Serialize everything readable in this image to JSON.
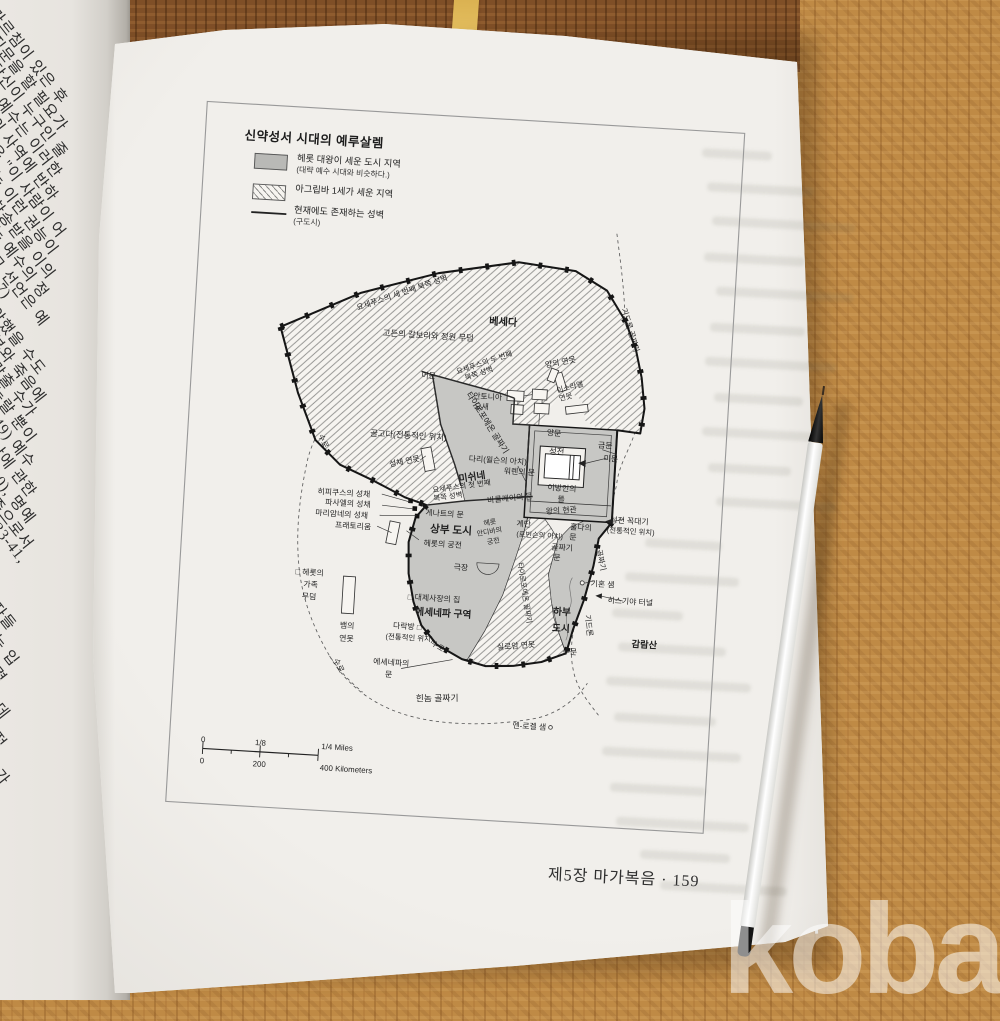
{
  "watermark": {
    "text": "kobay"
  },
  "book": {
    "footer": "제5장 마가복음 · 159"
  },
  "left_page": {
    "lines": [
      {
        "t": "가르침이 있은 후",
        "y": 3
      },
      {
        "t": "질문을 할 필요가",
        "y": 30
      },
      {
        "t": "당신이 누구인 줄",
        "y": 57
      },
      {
        "t": ") 예수는 이러한",
        "y": 84
      },
      {
        "t": "의 사역에 반하",
        "y": 112
      },
      {
        "t": "은 \"이 사람이 어",
        "y": 139
      },
      {
        "t": "는 이런 권능이",
        "y": 166
      },
      {
        "t": "찬송받을 이의",
        "y": 194
      },
      {
        "t": "는 예수의 정",
        "y": 221
      },
      {
        "t": "그 선언은 예",
        "y": 249
      },
      {
        "t": ":7)",
        "y": 276
      },
      {
        "t": "악했을 수도",
        "y": 302
      },
      {
        "t": "부와 죽음에",
        "y": 330
      },
      {
        "t": "맞출 수가",
        "y": 356
      },
      {
        "t": "놀랄 뿐이",
        "y": 382
      },
      {
        "t": ":49) 예수",
        "y": 408
      },
      {
        "t": "난에 관한",
        "y": 436
      },
      {
        "t": "10), 명예",
        "y": 464
      },
      {
        "t": "종으로서",
        "y": 492
      },
      {
        "t": "33-41,",
        "y": 520
      },
      {
        "t": "제자들",
        "y": 585
      },
      {
        "t": "되는 입",
        "y": 617
      },
      {
        "t": "세력",
        "y": 650
      },
      {
        "t": "는 데",
        "y": 682
      },
      {
        "t": "속적",
        "y": 715
      },
      {
        "t": "의 가",
        "y": 748
      },
      {
        "t": "꾸",
        "y": 778
      },
      {
        "t": "관",
        "y": 812
      },
      {
        "t": "있",
        "y": 845
      }
    ]
  },
  "map": {
    "title": "신약성서 시대의 예루살렘",
    "legend": [
      {
        "label": "헤롯 대왕이 세운 도시 지역",
        "sub": "(대략 예수 시대와 비슷하다.)",
        "swatch": "gray-fill"
      },
      {
        "label": "아그립바 1세가 세운 지역",
        "sub": "",
        "swatch": "hatch-fill"
      },
      {
        "label": "현재에도 존재하는 성벽",
        "sub": "(구도시)",
        "swatch": "wall-line"
      }
    ],
    "colors": {
      "herod_area": "#c7c7c4",
      "agrippa_hatch": "#9a9a98",
      "wall": "#161616"
    },
    "scale": {
      "miles": [
        "0",
        "1/8",
        "1/4 Miles"
      ],
      "kilometers": [
        "0",
        "200",
        "400 Kilometers"
      ]
    },
    "labels": [
      {
        "t": "요세푸스의 세 번째 북쪽 성벽",
        "x": 225,
        "y": 198,
        "r": -22,
        "s": 8.5
      },
      {
        "t": "베세다",
        "x": 335,
        "y": 224,
        "s": 11,
        "b": 1
      },
      {
        "t": "고든의 갈보리와 정원 무덤",
        "x": 255,
        "y": 243,
        "s": 9
      },
      {
        "t": "기드론 골짜기",
        "x": 470,
        "y": 222,
        "r": 70,
        "s": 8.5
      },
      {
        "t": "어문",
        "x": 258,
        "y": 286,
        "s": 8.5
      },
      {
        "t": "요세푸스의 두 번째",
        "x": 318,
        "y": 268,
        "r": -22,
        "s": 8
      },
      {
        "t": "북쪽 성벽",
        "x": 313,
        "y": 280,
        "r": -22,
        "s": 8
      },
      {
        "t": "양의 연못",
        "x": 400,
        "y": 263,
        "r": -14,
        "s": 8.5
      },
      {
        "t": "안토니아",
        "x": 323,
        "y": 305,
        "s": 8.5
      },
      {
        "t": "요새",
        "x": 317,
        "y": 316,
        "s": 8.5
      },
      {
        "t": "이스라엘",
        "x": 412,
        "y": 289,
        "r": -18,
        "s": 8
      },
      {
        "t": "연못",
        "x": 408,
        "y": 300,
        "r": -18,
        "s": 8
      },
      {
        "t": "타이로포에온 골짜기",
        "x": 322,
        "y": 332,
        "r": 54,
        "s": 9
      },
      {
        "t": "양문",
        "x": 397,
        "y": 340,
        "s": 8.5
      },
      {
        "t": "성전",
        "x": 401,
        "y": 360,
        "s": 9
      },
      {
        "t": "금문",
        "x": 453,
        "y": 350,
        "s": 8.5
      },
      {
        "t": "미문",
        "x": 460,
        "y": 364,
        "s": 8.5
      },
      {
        "t": "골고다(전통적인 위치)",
        "x": 240,
        "y": 352,
        "s": 9
      },
      {
        "t": "수로",
        "x": 146,
        "y": 362,
        "r": 62,
        "s": 8.5
      },
      {
        "t": "성채 연못",
        "x": 238,
        "y": 380,
        "r": -14,
        "s": 8.5
      },
      {
        "t": "다리(윌슨의 아치)",
        "x": 338,
        "y": 373,
        "s": 8.5
      },
      {
        "t": "워렌의 문",
        "x": 362,
        "y": 384,
        "s": 8.5
      },
      {
        "t": "미쉬네",
        "x": 312,
        "y": 393,
        "r": -12,
        "s": 10.5,
        "b": 1
      },
      {
        "t": "이방인의",
        "x": 409,
        "y": 399,
        "s": 8.5
      },
      {
        "t": "뜰",
        "x": 409,
        "y": 411,
        "s": 8.5
      },
      {
        "t": "요세푸스의 첫 번째",
        "x": 301,
        "y": 403,
        "r": -11,
        "s": 8
      },
      {
        "t": "북쪽 성벽",
        "x": 287,
        "y": 415,
        "r": -11,
        "s": 8
      },
      {
        "t": "바클레이의 문",
        "x": 354,
        "y": 413,
        "r": -9,
        "s": 8.5
      },
      {
        "t": "히피쿠스의 성채",
        "x": 174,
        "y": 418,
        "s": 8.5
      },
      {
        "t": "파사엘의 성채",
        "x": 179,
        "y": 429,
        "s": 8.5
      },
      {
        "t": "마리암네의 성채",
        "x": 173,
        "y": 441,
        "s": 8.5
      },
      {
        "t": "프래토리움",
        "x": 186,
        "y": 453,
        "s": 8.5
      },
      {
        "t": "게나트의 문",
        "x": 284,
        "y": 434,
        "s": 8.5
      },
      {
        "t": "상부 도시",
        "x": 292,
        "y": 452,
        "s": 11.5,
        "b": 1
      },
      {
        "t": "헤롯",
        "x": 334,
        "y": 440,
        "r": -14,
        "s": 7.5
      },
      {
        "t": "안디바의",
        "x": 334,
        "y": 450,
        "r": -14,
        "s": 7.5
      },
      {
        "t": "궁전",
        "x": 339,
        "y": 460,
        "r": -14,
        "s": 7.5
      },
      {
        "t": "계단",
        "x": 370,
        "y": 440,
        "s": 8.5
      },
      {
        "t": "(로빈슨의 아치)",
        "x": 388,
        "y": 451,
        "s": 7.8
      },
      {
        "t": "왕의 현관",
        "x": 410,
        "y": 423,
        "r": -7,
        "s": 8.5
      },
      {
        "t": "훌다의",
        "x": 432,
        "y": 440,
        "s": 8.5
      },
      {
        "t": "문",
        "x": 424,
        "y": 451,
        "s": 8.5
      },
      {
        "t": "성전 꼭대기",
        "x": 484,
        "y": 430,
        "s": 8.5
      },
      {
        "t": "(전통적인 위치)",
        "x": 486,
        "y": 441,
        "s": 8
      },
      {
        "t": "헤롯의 궁전",
        "x": 284,
        "y": 467,
        "s": 8.5
      },
      {
        "t": "골짜기",
        "x": 413,
        "y": 463,
        "s": 8.5
      },
      {
        "t": "문",
        "x": 408,
        "y": 474,
        "s": 8.5
      },
      {
        "t": "극장",
        "x": 305,
        "y": 491,
        "s": 8.5
      },
      {
        "t": "골짜기",
        "x": 453,
        "y": 472,
        "r": 74,
        "s": 8.5
      },
      {
        "t": "기혼 샘",
        "x": 459,
        "y": 500,
        "s": 8.5
      },
      {
        "t": "히스기야 터널",
        "x": 490,
        "y": 517,
        "s": 8.5
      },
      {
        "t": "□ 헤롯의",
        "x": 142,
        "y": 506,
        "s": 8.5
      },
      {
        "t": "가족",
        "x": 144,
        "y": 519,
        "s": 8.5
      },
      {
        "t": "무덤",
        "x": 143,
        "y": 532,
        "s": 8.5
      },
      {
        "t": "□ 대제사장의 집",
        "x": 278,
        "y": 526,
        "s": 8.5
      },
      {
        "t": "에세네파 구역",
        "x": 289,
        "y": 542,
        "s": 10.5,
        "b": 1
      },
      {
        "t": "하부",
        "x": 417,
        "y": 533,
        "s": 10.5,
        "b": 1
      },
      {
        "t": "도시",
        "x": 417,
        "y": 551,
        "s": 10.5,
        "b": 1
      },
      {
        "t": "타이로포에온 골짜기",
        "x": 373,
        "y": 512,
        "r": 78,
        "s": 7.8
      },
      {
        "t": "기드론",
        "x": 444,
        "y": 543,
        "r": 80,
        "s": 8.5
      },
      {
        "t": "감람산",
        "x": 508,
        "y": 563,
        "s": 10,
        "b": 1
      },
      {
        "t": "다락방 □",
        "x": 251,
        "y": 558,
        "s": 8.5
      },
      {
        "t": "(전통적인 위치)",
        "x": 254,
        "y": 570,
        "s": 8
      },
      {
        "t": "뱀의",
        "x": 186,
        "y": 561,
        "s": 8.5
      },
      {
        "t": "연못",
        "x": 186,
        "y": 575,
        "s": 8.5
      },
      {
        "t": "실로암 연못",
        "x": 370,
        "y": 572,
        "r": -8,
        "s": 8.5
      },
      {
        "t": "수문",
        "x": 428,
        "y": 575,
        "s": 8.5
      },
      {
        "t": "수로",
        "x": 284,
        "y": 577,
        "r": 28,
        "s": 8
      },
      {
        "t": "에세네파의",
        "x": 236,
        "y": 598,
        "s": 8.5
      },
      {
        "t": "문",
        "x": 234,
        "y": 611,
        "s": 8.5
      },
      {
        "t": "수로",
        "x": 177,
        "y": 603,
        "r": 60,
        "s": 8.5
      },
      {
        "t": "힌놈 골짜기",
        "x": 288,
        "y": 634,
        "r": -4,
        "s": 9.5
      },
      {
        "t": "엔-로겔 샘",
        "x": 389,
        "y": 658,
        "s": 8.5
      },
      {
        "t": "0",
        "x": 38,
        "y": 693,
        "s": 8.5
      },
      {
        "t": "1/8",
        "x": 100,
        "y": 693,
        "s": 8.5
      },
      {
        "t": "1/4 Miles",
        "x": 183,
        "y": 693,
        "s": 8.5
      },
      {
        "t": "0",
        "x": 38,
        "y": 716,
        "s": 8.5
      },
      {
        "t": "200",
        "x": 100,
        "y": 716,
        "s": 8.5
      },
      {
        "t": "400 Kilometers",
        "x": 194,
        "y": 716,
        "s": 8.5
      }
    ]
  }
}
